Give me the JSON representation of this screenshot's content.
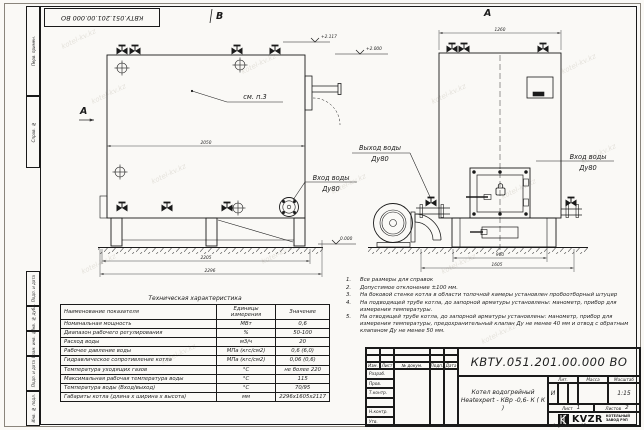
{
  "sheet": {
    "watermark": "kotel-kv.kz",
    "margin_labels": [
      "Перв. примен.",
      "Справ. №",
      "Подп. и дата",
      "Инв. № дубл.",
      "Взам. инв. №",
      "Подп. и дата",
      "Инв. № подл."
    ],
    "format_label": "Формат",
    "format_value": "А3"
  },
  "views": {
    "view_b_label": "B",
    "view_a_label": "A",
    "section_a_label": "A",
    "callout_see_note": "см. п.3",
    "labels": {
      "outlet_line1": "Выход воды",
      "outlet_line2": "Ду80",
      "inlet_left_line1": "Вход воды",
      "inlet_left_line2": "Ду80",
      "inlet_right_line1": "Вход воды",
      "inlet_right_line2": "Ду80"
    },
    "elevations": {
      "top": "+2.117",
      "flue": "+2.000",
      "ground": "0.000"
    },
    "dimensions": {
      "left_width": "2050",
      "left_frame": "2205",
      "left_overall": "2296",
      "front_top": "1260",
      "front_base": "960",
      "front_overall": "1605"
    }
  },
  "notes": {
    "items": [
      {
        "num": "1.",
        "text": "Все размеры для справок"
      },
      {
        "num": "2.",
        "text": "Допустимое отклонение ±100 мм."
      },
      {
        "num": "3.",
        "text": "На боковой стенке котла в области топочной камеры установлен пробоотборный штуцер"
      },
      {
        "num": "4.",
        "text": "На подводящей трубе котла, до запорной арматуры установлены: манометр, прибор для измерения температуры."
      },
      {
        "num": "5.",
        "text": "На отводящей трубе котла, до запорной арматуры установлены: манометр, прибор для измерения температуры, предохранительный клапан Ду не менее 40 мм и отвод с обратным клапаном Ду не менее 50 мм."
      }
    ]
  },
  "tech_table": {
    "title": "Техническая характеристика",
    "headers": {
      "name": "Наименование показателя",
      "units": "Единицы\nизмерения",
      "value": "Значение"
    },
    "rows": [
      [
        "Номинальная мощность",
        "МВт",
        "0,6"
      ],
      [
        "Диапазон рабочего регулирования",
        "%",
        "50-100"
      ],
      [
        "Расход воды",
        "м3/ч",
        "20"
      ],
      [
        "Рабочее давление воды",
        "МПа (кгс/см2)",
        "0,6 (6,0)"
      ],
      [
        "Гидравлическое сопротивление котла",
        "МПа (кгс/см2)",
        "0,06 (0,6)"
      ],
      [
        "Температура уходящих газов",
        "°С",
        "не более 220"
      ],
      [
        "Максимальная рабочая температура воды",
        "°С",
        "115"
      ],
      [
        "Температура воды (Вход/выход)",
        "°С",
        "70/95"
      ],
      [
        "Габариты котла (длина х ширина х высота)",
        "мм",
        "2296х1605х2117"
      ]
    ]
  },
  "title_block": {
    "doc_number": "КВТУ.051.201.00.000  ВО",
    "product_name_line1": "Котел водогрейный",
    "product_name_line2": "Heatexpert - КВр -0,6- К ( К )",
    "header_cols": [
      "Изм.",
      "Лист",
      "№ докум.",
      "Подп.",
      "Дата"
    ],
    "row_labels": [
      "Разраб.",
      "Пров.",
      "Т.контр.",
      "",
      "Н.контр.",
      "Утв."
    ],
    "lit_header": "Лит.",
    "mass_header": "Масса",
    "scale_header": "Масштаб",
    "lit_value": "И",
    "scale_value": "1:15",
    "sheet_label": "Лист",
    "sheet_value": "1",
    "sheets_label": "Листов",
    "sheets_value": "2",
    "logo_text": "KVZR",
    "company_line1": "КОТЕЛЬНЫЙ",
    "company_line2": "ЗАВОД РЭП"
  }
}
